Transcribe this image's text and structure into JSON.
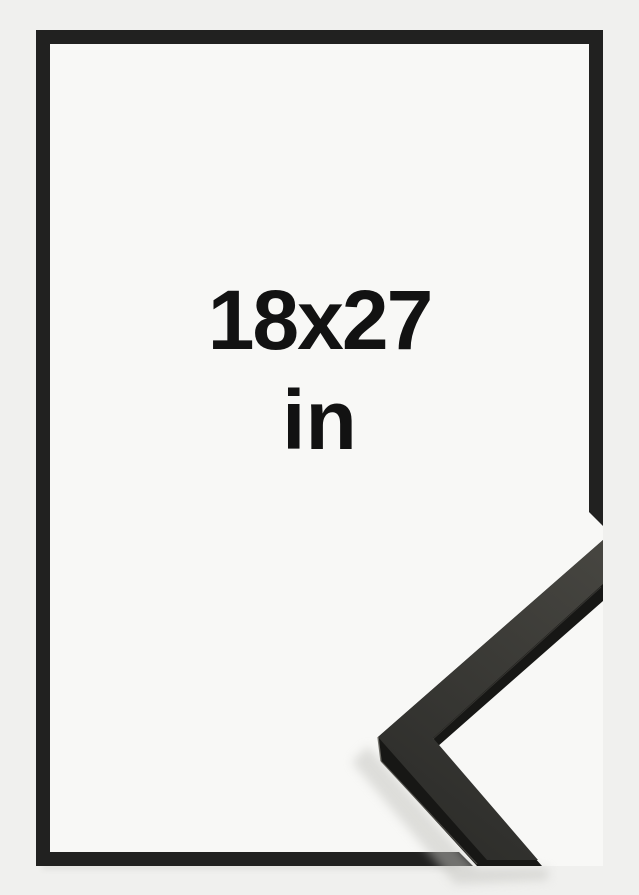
{
  "product": {
    "size_value": "18x27",
    "size_unit": "in"
  },
  "colors": {
    "background": "#f0f0ee",
    "paper": "#f8f8f6",
    "frame_border": "#212120",
    "moulding_front": "#171715",
    "moulding_top_light": "#474641",
    "moulding_top_dark": "#2e2e2b",
    "edge_highlight": "#6e6d66",
    "edge_highlight_soft": "#55544e",
    "shadow": "#c2c2be",
    "text": "#121212"
  }
}
